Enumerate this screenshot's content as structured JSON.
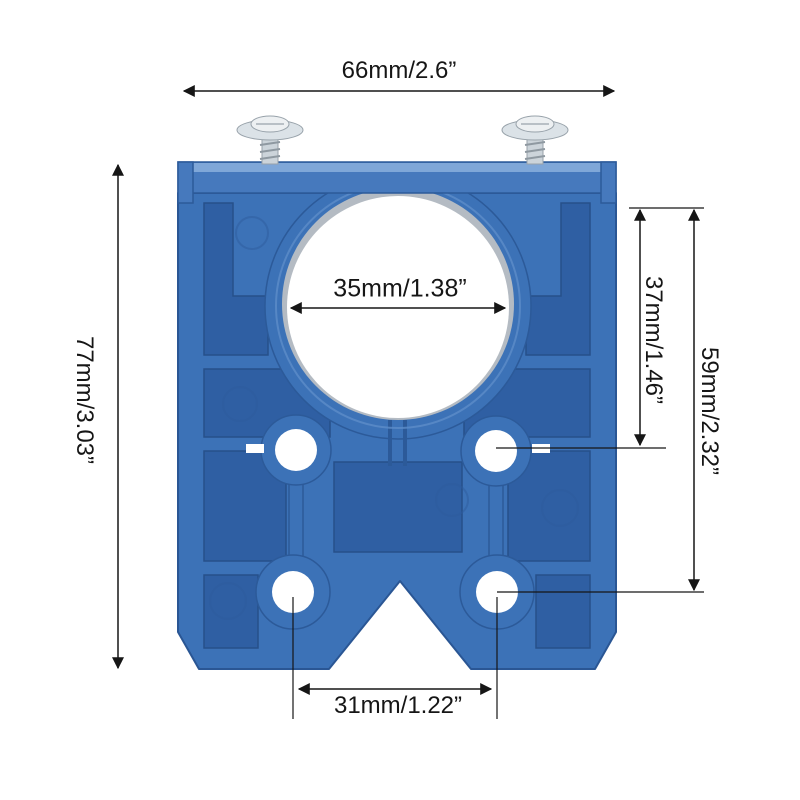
{
  "page": {
    "background": "#ffffff",
    "description": "Dimension diagram of a blue 35mm concealed-hinge drilling jig with two mounting screws"
  },
  "dimensions": {
    "overall_width": "66mm/2.6”",
    "overall_height": "77mm/3.03”",
    "bore_diameter": "35mm/1.38”",
    "bore_top_to_guide_holes": "37mm/1.46”",
    "bore_top_to_lower_holes": "59mm/2.32”",
    "lower_hole_spacing": "31mm/1.22”"
  },
  "colors": {
    "jig_main": "#3c72b7",
    "jig_recess": "#2f5fa3",
    "jig_bevel": "#7fa7d8",
    "jig_bar": "#4679bd",
    "jig_outline": "#2a5694",
    "bore_rim": "#b4bbc3",
    "hole_white": "#ffffff",
    "screw_metal_head": "#dbe2e7",
    "screw_metal_dome": "#edf0f2",
    "screw_metal_shank": "#ccd4da",
    "dimension_line": "#161616"
  }
}
